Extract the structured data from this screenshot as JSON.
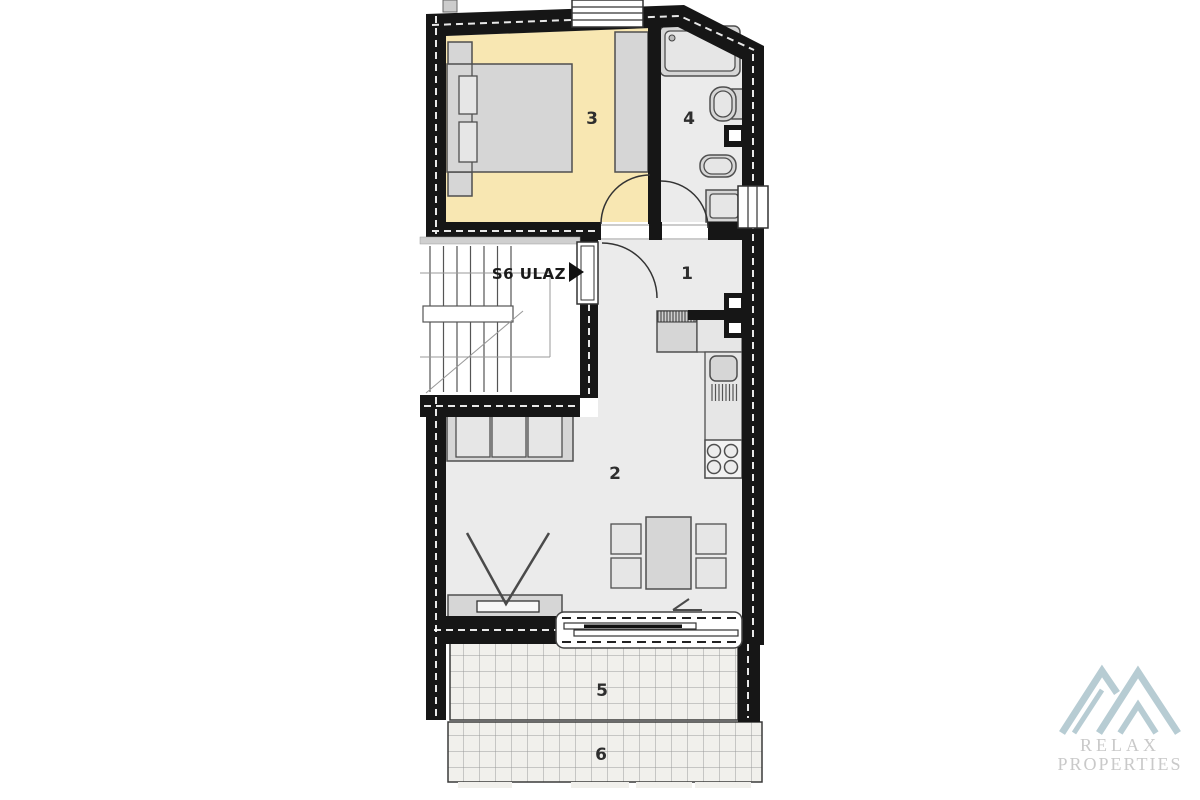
{
  "floorplan": {
    "entrance_label": "S6 ULAZ",
    "room_numbers": {
      "hallway": "1",
      "living_room": "2",
      "bedroom": "3",
      "bathroom": "4",
      "terrace": "5",
      "lower_terrace": "6"
    }
  },
  "watermark": {
    "name_line1": "RELAX",
    "name_line2": "PROPERTIES"
  },
  "colors": {
    "wall": "#161616",
    "bedroom_floor": "#f8e7b2",
    "room_floor": "#ebebeb",
    "stair_floor": "#ffffff",
    "furniture_fill": "#d6d6d6",
    "furniture_stroke": "#4f4f4f",
    "terrace_tile_bg": "#f1f0ec",
    "terrace_tile_line": "#9b9b9b",
    "logo_mark": "#b7ccd3",
    "logo_text": "#c9c9c9"
  }
}
